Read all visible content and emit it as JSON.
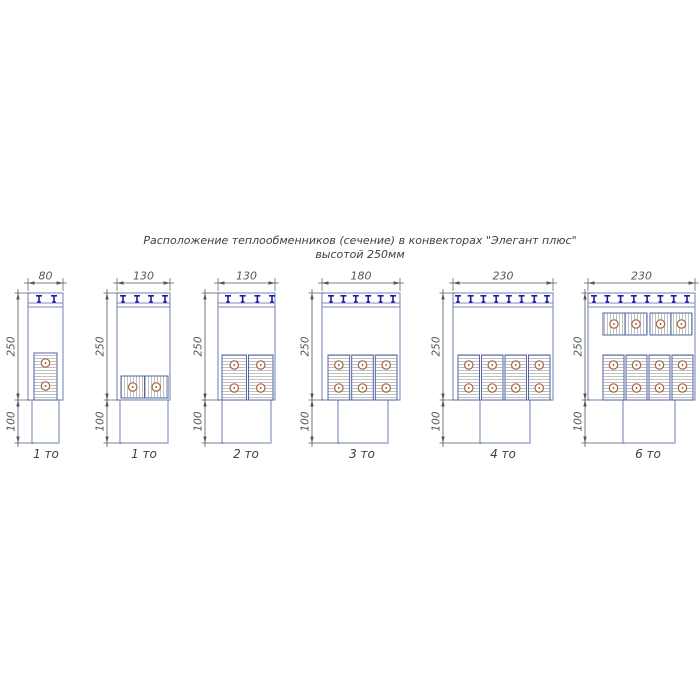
{
  "title": {
    "line1": "Расположение теплообменников (сечение) в конвекторах \"Элегант плюс\"",
    "line2": "высотой 250мм"
  },
  "diagrams": [
    {
      "caption": "1 то",
      "width_mm": "80",
      "height_mm": "250",
      "foot_mm": "100",
      "grille_tees": 2,
      "tube_count": 2,
      "exchanger_layout": "1 vertical block with 2 tubes"
    },
    {
      "caption": "1 то",
      "width_mm": "130",
      "height_mm": "250",
      "foot_mm": "100",
      "grille_tees": 4,
      "tube_count": 2,
      "exchanger_layout": "1 horizontal block with 2 tubes"
    },
    {
      "caption": "2 то",
      "width_mm": "130",
      "height_mm": "250",
      "foot_mm": "100",
      "grille_tees": 4,
      "tube_count": 4,
      "exchanger_layout": "2 vertical blocks with 2 tubes each"
    },
    {
      "caption": "3 то",
      "width_mm": "180",
      "height_mm": "250",
      "foot_mm": "100",
      "grille_tees": 6,
      "tube_count": 6,
      "exchanger_layout": "3 vertical blocks with 2 tubes each"
    },
    {
      "caption": "4 то",
      "width_mm": "230",
      "height_mm": "250",
      "foot_mm": "100",
      "grille_tees": 8,
      "tube_count": 8,
      "exchanger_layout": "4 vertical blocks with 2 tubes each"
    },
    {
      "caption": "6 то",
      "width_mm": "230",
      "height_mm": "250",
      "foot_mm": "100",
      "grille_tees": 8,
      "tube_count": 12,
      "exchanger_layout": "2 horizontal top blocks with 2 tubes each plus 4 vertical blocks with 2 tubes each"
    }
  ],
  "colors": {
    "background": "#ffffff",
    "outline": "#7b8abf",
    "block_border": "#5565a8",
    "grille_tee": "#1d1d9c",
    "hatch": "#b2b2b2",
    "tube": "#a06743",
    "dimension": "#55565f",
    "text": "#3e3e49"
  }
}
